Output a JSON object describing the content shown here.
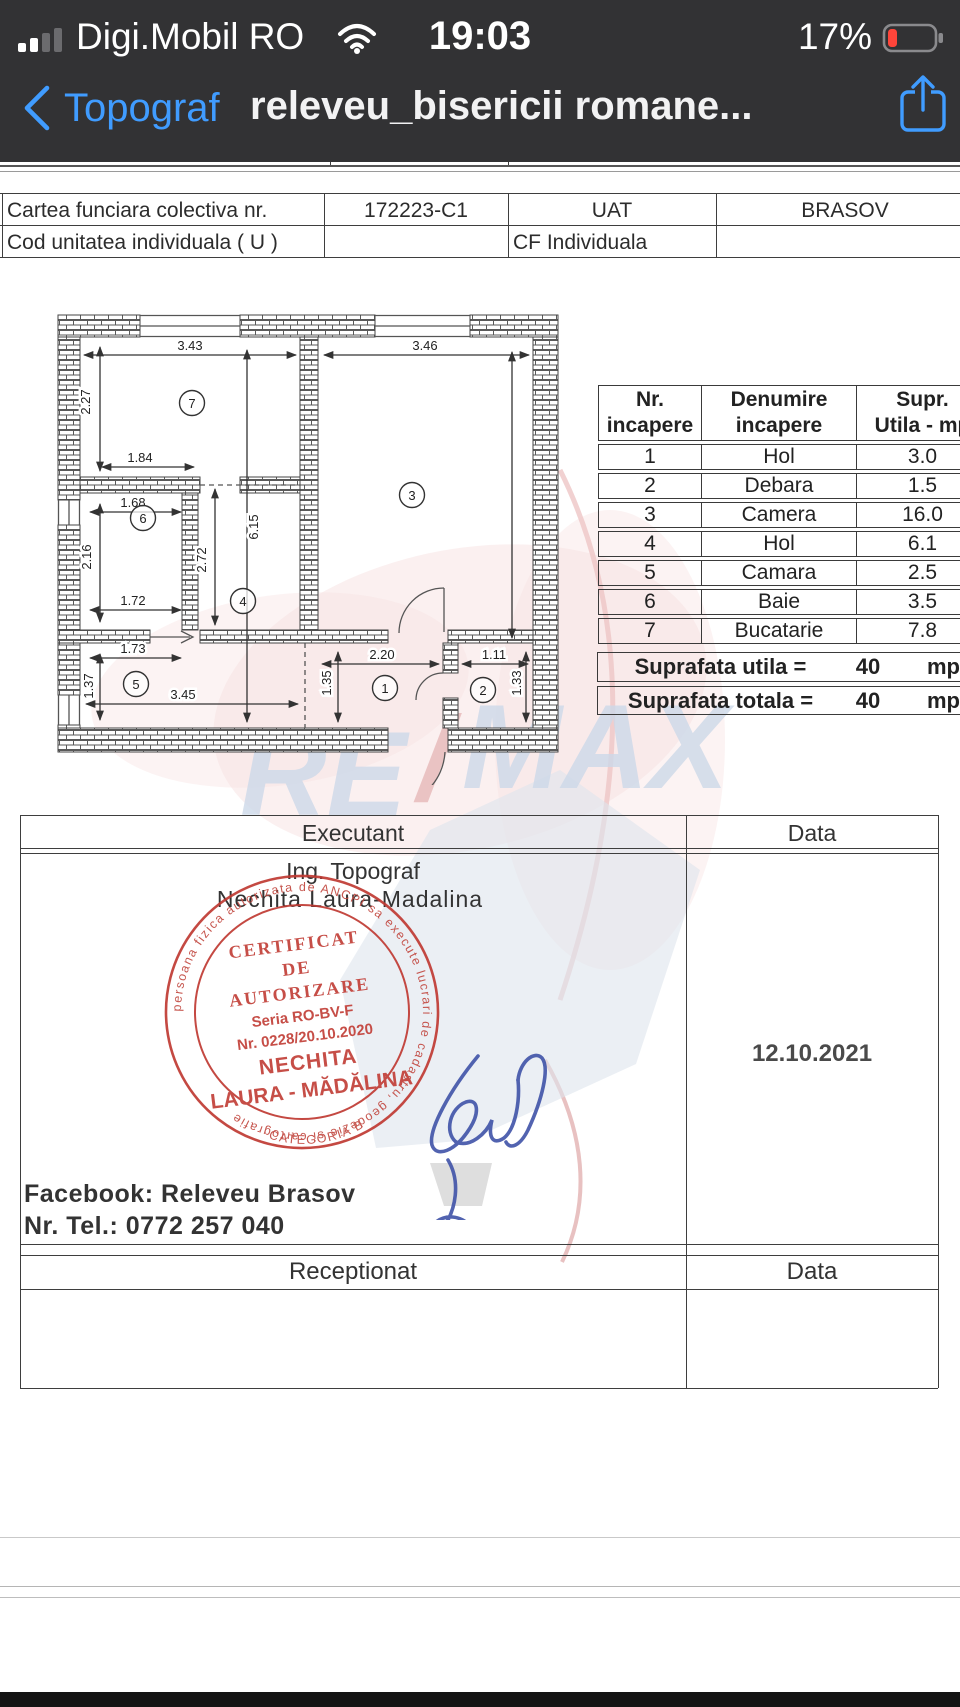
{
  "status_bar": {
    "carrier": "Digi.Mobil RO",
    "time": "19:03",
    "battery_percent": "17%"
  },
  "nav_bar": {
    "back_label": "Topograf",
    "title": "releveu_bisericii romane..."
  },
  "colors": {
    "bar_bg": "#323234",
    "accent_blue": "#409cff",
    "battery_red": "#ff453a",
    "stamp_red": "#c23f38",
    "signature_blue": "#4053a8",
    "watermark_pink": "#f8e2e2",
    "watermark_blue": "#cdd9e9"
  },
  "cf_table": {
    "rows": [
      [
        "Cartea funciara colectiva nr.",
        "172223-C1",
        "UAT",
        "BRASOV"
      ],
      [
        "Cod unitatea individuala ( U )",
        "",
        "CF Individuala",
        ""
      ]
    ]
  },
  "room_table": {
    "headers": [
      {
        "l1": "Nr.",
        "l2": "incapere"
      },
      {
        "l1": "Denumire",
        "l2": "incapere"
      },
      {
        "l1": "Supr.",
        "l2": "Utila - mp"
      }
    ],
    "rows": [
      [
        "1",
        "Hol",
        "3.0"
      ],
      [
        "2",
        "Debara",
        "1.5"
      ],
      [
        "3",
        "Camera",
        "16.0"
      ],
      [
        "4",
        "Hol",
        "6.1"
      ],
      [
        "5",
        "Camara",
        "2.5"
      ],
      [
        "6",
        "Baie",
        "3.5"
      ],
      [
        "7",
        "Bucatarie",
        "7.8"
      ]
    ],
    "totals": [
      {
        "label": "Suprafata  utila =",
        "value": "40",
        "unit": "mp"
      },
      {
        "label": "Suprafata  totala =",
        "value": "40",
        "unit": "mp"
      }
    ]
  },
  "floorplan": {
    "dimensions": [
      {
        "label": "3.43",
        "x": 190,
        "y": 350,
        "rot": 0
      },
      {
        "label": "3.46",
        "x": 425,
        "y": 350,
        "rot": 0
      },
      {
        "label": "2.27",
        "x": 90,
        "y": 402,
        "rot": -90
      },
      {
        "label": "1.84",
        "x": 140,
        "y": 462,
        "rot": 0
      },
      {
        "label": "6.15",
        "x": 258,
        "y": 527,
        "rot": -90
      },
      {
        "label": "2.72",
        "x": 206,
        "y": 560,
        "rot": -90
      },
      {
        "label": "1.68",
        "x": 133,
        "y": 507,
        "rot": 0
      },
      {
        "label": "2.16",
        "x": 91,
        "y": 557,
        "rot": -90
      },
      {
        "label": "1.72",
        "x": 133,
        "y": 605,
        "rot": 0
      },
      {
        "label": "1.73",
        "x": 133,
        "y": 653,
        "rot": 0
      },
      {
        "label": "1.37",
        "x": 93,
        "y": 686,
        "rot": -90
      },
      {
        "label": "3.45",
        "x": 183,
        "y": 699,
        "rot": 0
      },
      {
        "label": "2.20",
        "x": 382,
        "y": 659,
        "rot": 0
      },
      {
        "label": "1.11",
        "x": 494,
        "y": 659,
        "rot": 0
      },
      {
        "label": "1.35",
        "x": 331,
        "y": 683,
        "rot": -90
      },
      {
        "label": "1.33",
        "x": 521,
        "y": 683,
        "rot": -90
      }
    ],
    "rooms": [
      {
        "n": "7",
        "x": 192,
        "y": 403
      },
      {
        "n": "3",
        "x": 412,
        "y": 495
      },
      {
        "n": "6",
        "x": 143,
        "y": 518
      },
      {
        "n": "4",
        "x": 243,
        "y": 601
      },
      {
        "n": "5",
        "x": 136,
        "y": 684
      },
      {
        "n": "1",
        "x": 385,
        "y": 688
      },
      {
        "n": "2",
        "x": 483,
        "y": 690
      }
    ]
  },
  "watermark": {
    "re": "RE",
    "slash": "/",
    "max": "MAX"
  },
  "stamp": {
    "ring_text": "persoana fizica autorizata de ANCPI sa execute lucrari de cadastru, geodezie si cartografie",
    "ring_bottom": "CATEGORIA B",
    "lines": [
      "CERTIFICAT",
      "DE",
      "AUTORIZARE",
      "Seria RO-BV-F",
      "Nr. 0228/20.10.2020",
      "NECHITA",
      "LAURA - MĂDĂLINA"
    ]
  },
  "signature_block": {
    "executant_label": "Executant",
    "data_label": "Data",
    "executant_line1": "Ing. Topograf",
    "executant_line2": "Nechita Laura-Madalina",
    "date": "12.10.2021",
    "facebook_line": "Facebook: Releveu Brasov",
    "tel_line": "Nr. Tel.: 0772 257 040",
    "receptionat_label": "Receptionat",
    "data_label_2": "Data"
  }
}
